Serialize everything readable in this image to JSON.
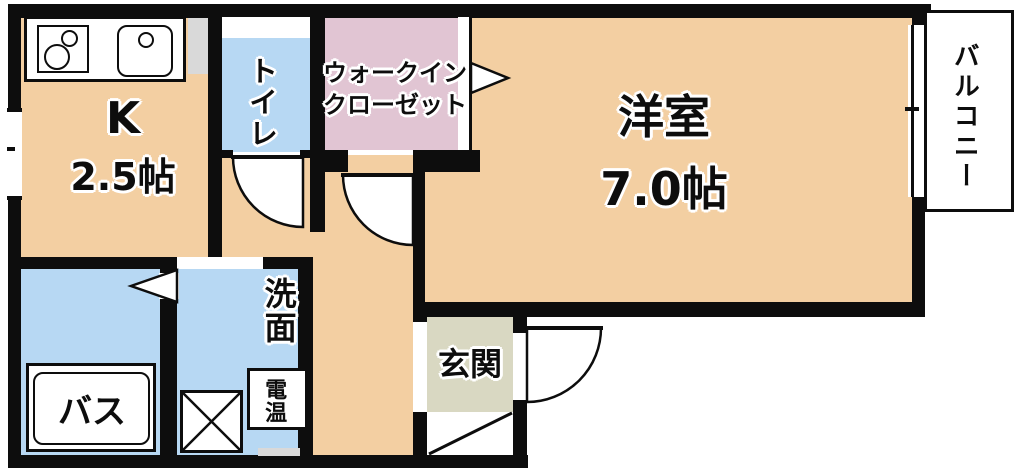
{
  "rooms": {
    "kitchen": {
      "label": "K",
      "size": "2.5帖"
    },
    "toilet": {
      "label": "トイレ"
    },
    "walk_in_closet": {
      "line1": "ウォークイン",
      "line2": "クローゼット"
    },
    "western_room": {
      "label": "洋室",
      "size": "7.0帖"
    },
    "balcony": {
      "label": "バルコニー"
    },
    "washroom": {
      "label": "洗面"
    },
    "bath": {
      "label": "バス"
    },
    "water_heater": {
      "label": "電温"
    },
    "entrance": {
      "label": "玄関"
    }
  },
  "colors": {
    "wall": "#0d0d0d",
    "room_tan": "#f3cfa2",
    "wet_blue": "#b7d8f3",
    "closet_pink": "#e1c5d3",
    "entrance_beige": "#d9d8c2",
    "duct_gray": "#d9d9d9",
    "background": "#ffffff"
  }
}
